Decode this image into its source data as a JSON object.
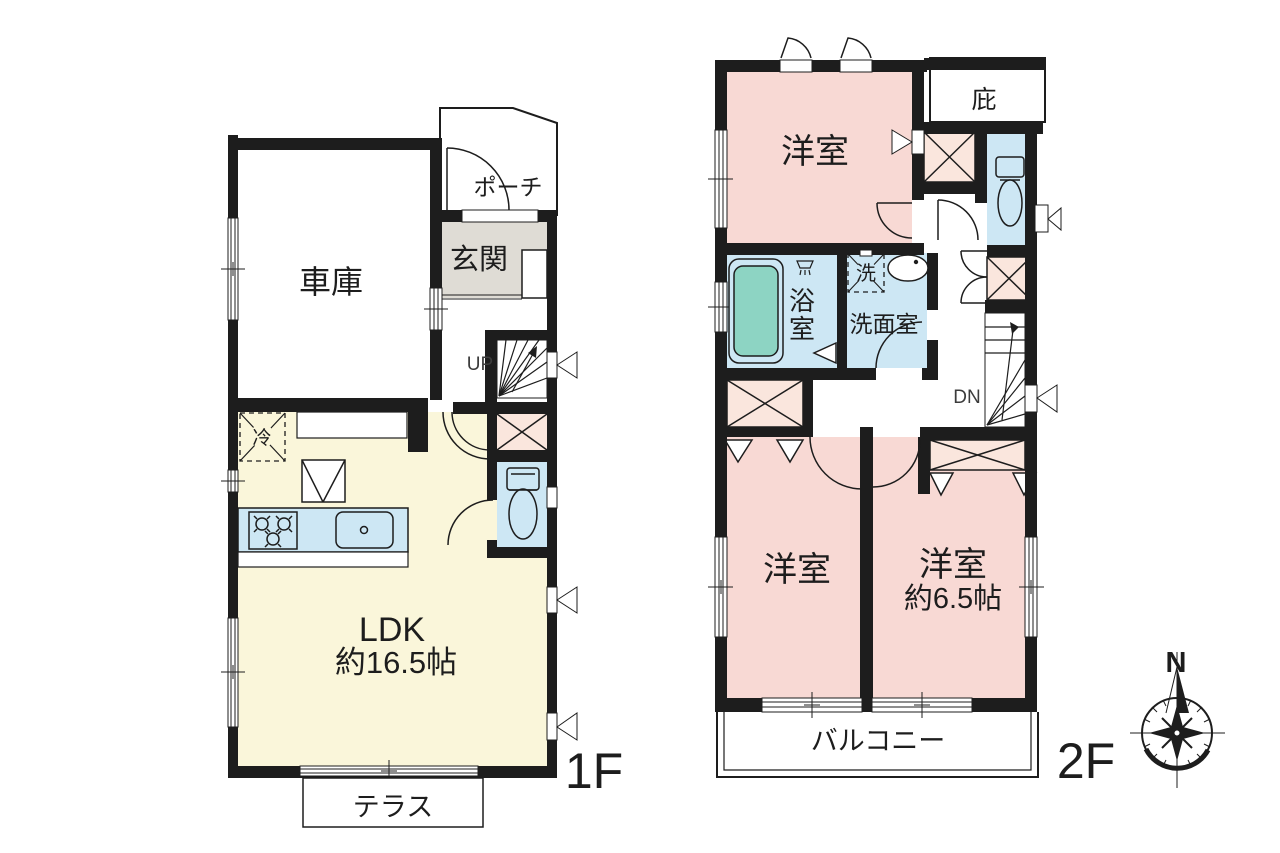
{
  "floor1": {
    "floor_label": "1F",
    "garage": "車庫",
    "porch": "ポーチ",
    "entrance": "玄関",
    "stairs_up": "UP",
    "ldk": "LDK",
    "ldk_size": "約16.5帖",
    "refrigerator": "冷",
    "terrace": "テラス"
  },
  "floor2": {
    "floor_label": "2F",
    "bedroom_north": "洋室",
    "eaves": "庇",
    "bathroom_char1": "浴",
    "bathroom_char2": "室",
    "laundry": "洗",
    "washroom": "洗面室",
    "stairs_down": "DN",
    "bedroom_southwest": "洋室",
    "bedroom_southeast": "洋室",
    "bedroom_southeast_size": "約6.5帖",
    "balcony": "バルコニー"
  },
  "compass": {
    "north_label": "N"
  },
  "palette": {
    "wall": "#1d1d1d",
    "room_pink": "#f8d9d4",
    "closet_pink": "#fae6dd",
    "ldk_yellow": "#faf6da",
    "water_blue": "#cde7f4",
    "bathtub_green": "#8dd4c3",
    "entrance_gray": "#dfdcd5"
  }
}
